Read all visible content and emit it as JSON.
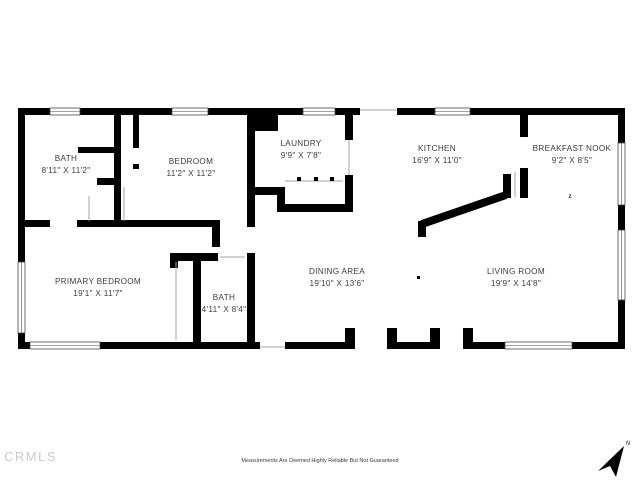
{
  "rooms": {
    "bath1": {
      "name": "BATH",
      "dims": "8'11\" X 11'2\""
    },
    "bedroom": {
      "name": "BEDROOM",
      "dims": "11'2\" X 11'2\""
    },
    "laundry": {
      "name": "LAUNDRY",
      "dims": "9'9\" X 7'8\""
    },
    "kitchen": {
      "name": "KITCHEN",
      "dims": "16'9\" X 11'0\""
    },
    "breakfast_nook": {
      "name": "BREAKFAST NOOK",
      "dims": "9'2\" X 8'5\""
    },
    "primary_bedroom": {
      "name": "PRIMARY BEDROOM",
      "dims": "19'1\" X 11'7\""
    },
    "bath2": {
      "name": "BATH",
      "dims": "4'11\" X 8'4\""
    },
    "dining": {
      "name": "DINING AREA",
      "dims": "19'10\" X 13'6\""
    },
    "living": {
      "name": "LIVING ROOM",
      "dims": "19'9\" X 14'8\""
    }
  },
  "annotations": {
    "nook_marker": "z",
    "compass_label": "N"
  },
  "watermark": "CRMLS",
  "disclaimer": "Measurements Are Deemed Highly Reliable But Not Guaranteed",
  "colors": {
    "wall": "#000000",
    "label": "#3c3c3c",
    "watermark": "#cbcbcb"
  }
}
